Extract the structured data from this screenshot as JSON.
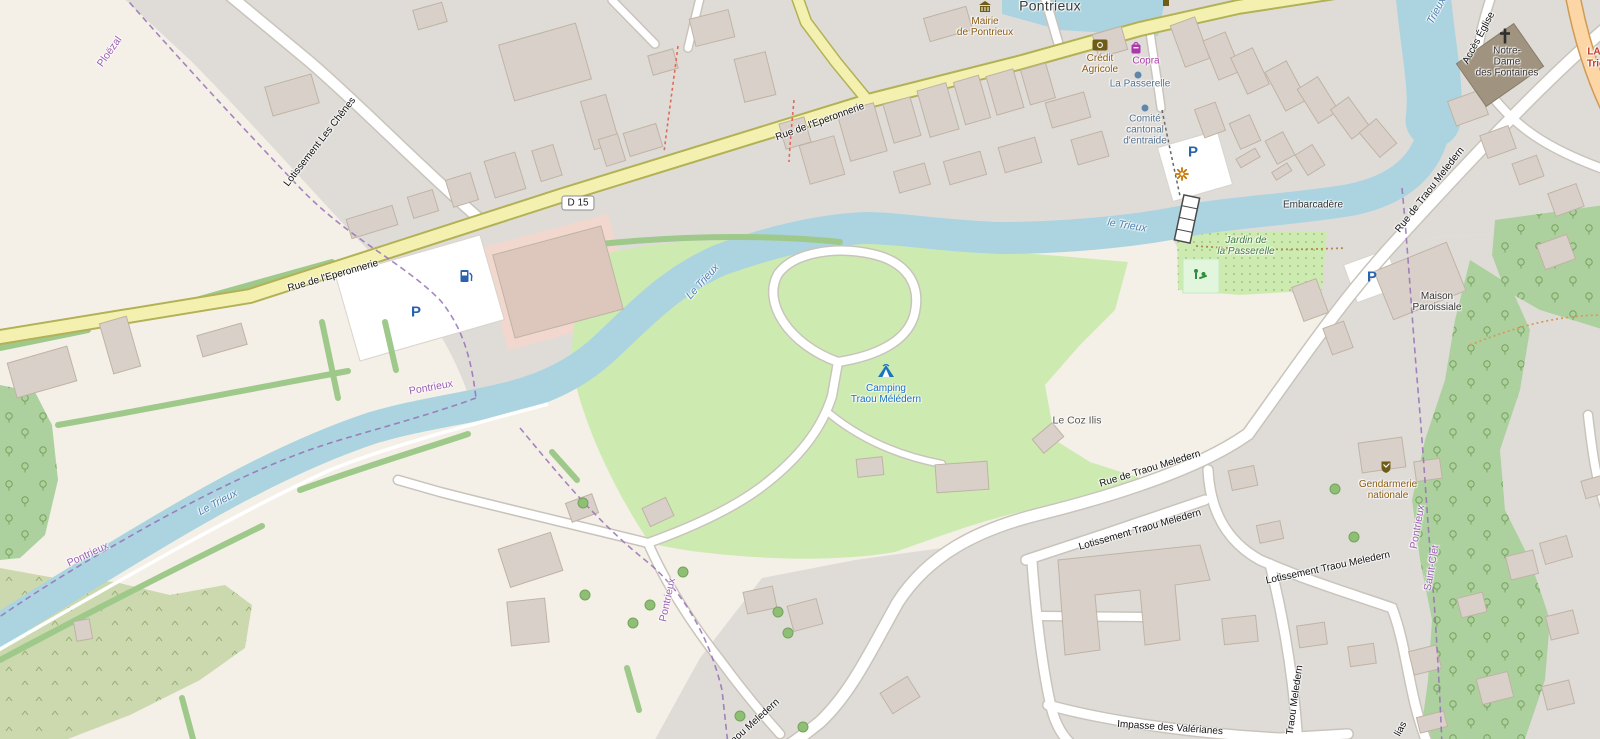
{
  "map_type": "openstreetmap-style street map of Pontrieux (Brittany)",
  "places": {
    "city": "Pontrieux",
    "hamlet": "Le Coz Ilis"
  },
  "roads": {
    "eperonnerie": "Rue de l'Eperonnerie",
    "d15": "D 15",
    "les_chenes": "Lotissement Les Chênes",
    "traou_meledern": "Rue de Traou Meledern",
    "lotissement_traou": "Lotissement Traou Meledern",
    "impasse_valerianes": "Impasse des Valérianes",
    "acces_eglise": "Accès Église",
    "traou_meledern_vertical": "Traou Meledern",
    "lias_fragment": "lias",
    "route_ref": [
      "LA",
      "Trig"
    ]
  },
  "water": {
    "river_main": "Le Trieux",
    "river_lower": "le Trieux",
    "river_short": "Trieux"
  },
  "boundaries": {
    "pontrieux": "Pontrieux",
    "ploezal": "Ploëzal",
    "saint_clet": "Saint-Clet"
  },
  "pois": {
    "mairie": {
      "lines": [
        "Mairie",
        "de Pontrieux"
      ]
    },
    "credit_agricole": {
      "lines": [
        "Crédit",
        "Agricole"
      ]
    },
    "copra": {
      "label": "Copra"
    },
    "la_passerelle": {
      "label": "La Passerelle"
    },
    "comite": {
      "lines": [
        "Comité",
        "cantonal",
        "d'entraide"
      ]
    },
    "embarcadere": {
      "label": "Embarcadère"
    },
    "jardin": {
      "lines": [
        "Jardin de",
        "la Passerelle"
      ]
    },
    "maison_paroissiale": {
      "lines": [
        "Maison",
        "Paroissiale"
      ]
    },
    "notre_dame": {
      "lines": [
        "Notre-",
        "Dame",
        "des Fontaines"
      ]
    },
    "gendarmerie": {
      "lines": [
        "Gendarmerie",
        "nationale"
      ]
    },
    "camping": {
      "lines": [
        "Camping",
        "Traou Mélédern"
      ]
    },
    "parking": "P"
  },
  "icons": {
    "town_hall": "town-hall-icon",
    "bank": "bank-icon",
    "shop": "shop-icon",
    "poi_dot": "poi-dot-icon",
    "attraction": "attraction-asterisk-icon",
    "parking": "parking-icon",
    "fuel": "fuel-icon",
    "camping": "tent-icon",
    "church": "christian-cross-icon",
    "playground": "playground-icon",
    "police": "gendarmerie-icon",
    "monument": "monument-icon"
  },
  "colors": {
    "water": "#abd4e0",
    "residential": "#dfdcd8",
    "farmland": "#f4f0e7",
    "forest": "#add19e",
    "scrub": "#ccd9ae",
    "camping_area": "#cdebb0",
    "road_secondary": "#f4f1b0",
    "road_primary": "#fcd6a4",
    "building": "#d9d0c9",
    "retail_pink": "#f1d7cd",
    "boundary_purple": "#9771b5",
    "poi_brown": "#8a5a12",
    "poi_purple": "#ac39ac",
    "parking_blue": "#2a62ad",
    "water_label": "#4d7fb2",
    "park_label": "#3f7d3f",
    "camping_label": "#1a6fc4",
    "route_ref_red": "#c0392b"
  }
}
